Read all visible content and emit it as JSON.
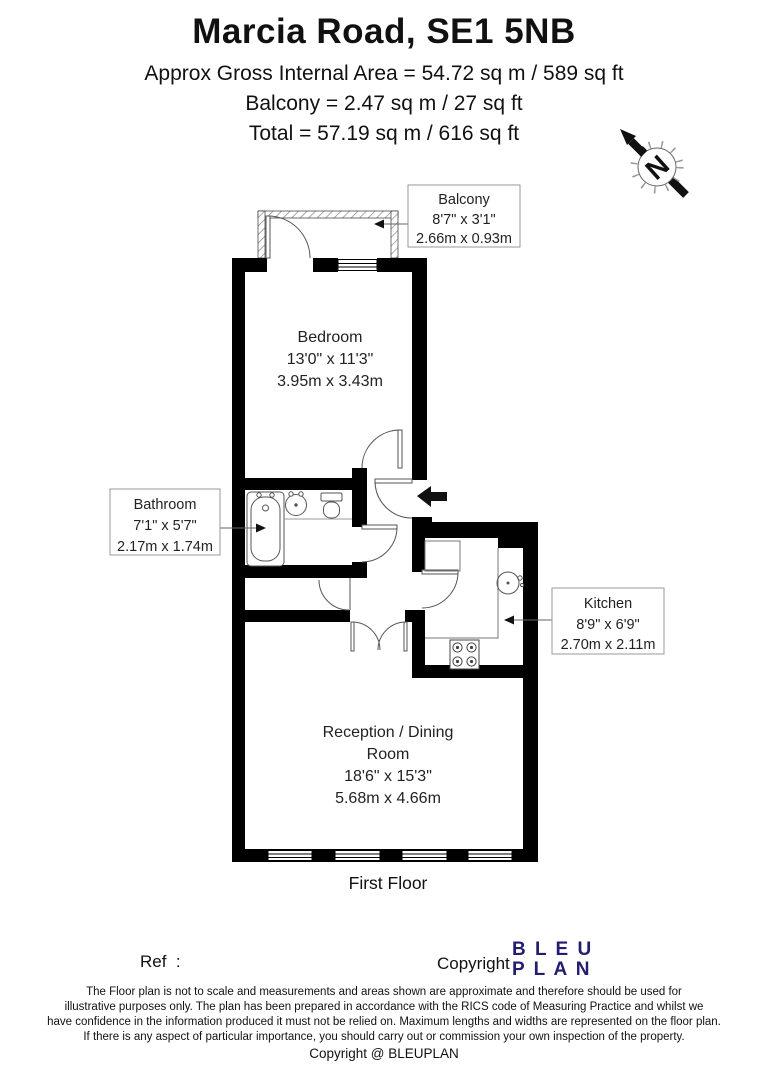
{
  "header": {
    "title": "Marcia Road, SE1 5NB",
    "area_line": "Approx Gross Internal Area = 54.72 sq m / 589 sq ft",
    "balcony_line": "Balcony = 2.47 sq m / 27 sq ft",
    "total_line": "Total = 57.19 sq m / 616 sq ft"
  },
  "compass": {
    "label": "N"
  },
  "rooms": {
    "balcony": {
      "name": "Balcony",
      "imperial": "8'7\" x 3'1\"",
      "metric": "2.66m x 0.93m"
    },
    "bedroom": {
      "name": "Bedroom",
      "imperial": "13'0\" x 11'3\"",
      "metric": "3.95m x 3.43m"
    },
    "bathroom": {
      "name": "Bathroom",
      "imperial": "7'1\" x 5'7\"",
      "metric": "2.17m x 1.74m"
    },
    "kitchen": {
      "name": "Kitchen",
      "imperial": "8'9\" x 6'9\"",
      "metric": "2.70m x 2.11m"
    },
    "reception": {
      "name_line1": "Reception / Dining",
      "name_line2": "Room",
      "imperial": "18'6\" x 15'3\"",
      "metric": "5.68m x 4.66m"
    }
  },
  "floor_label": "First Floor",
  "footer": {
    "ref_label": "Ref  :",
    "copyright_label": "Copyright",
    "logo_line1": "B L E U",
    "logo_line2": "P L A N",
    "disclaimer_lines": [
      "The Floor plan is not to scale and measurements and areas shown are approximate and therefore should be used for",
      "illustrative purposes only. The plan has been prepared in accordance with the RICS code of Measuring Practice and whilst we",
      "have confidence in the information produced it must not be relied on. Maximum lengths and widths are represented on the floor plan.",
      "If there is any aspect of particular importance, you should carry out or commission your own inspection of the property."
    ],
    "copyright_line": "Copyright @ BLEUPLAN"
  },
  "colors": {
    "wall": "#000000",
    "logo": "#221d6e"
  }
}
